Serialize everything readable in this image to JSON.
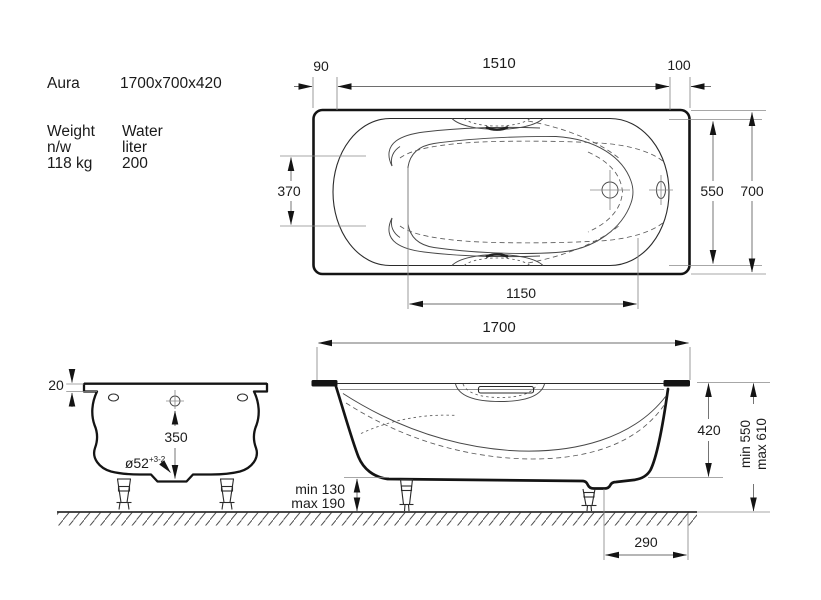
{
  "header": {
    "model": "Aura",
    "overall_size": "1700x700x420"
  },
  "specs": {
    "weight": {
      "label": "Weight",
      "sub_label": "n/w",
      "value": "118 kg"
    },
    "water": {
      "label": "Water",
      "sub_label": "liter",
      "value": "200"
    }
  },
  "top_view": {
    "left_offset": "90",
    "drain_span": "1510",
    "right_offset": "100",
    "well_width_left": "370",
    "inner_width": "550",
    "outer_width": "700",
    "well_length": "1150",
    "overall_length": "1700"
  },
  "section_view": {
    "rim_thickness": "20",
    "depth_to_drain": "350",
    "drain_diameter": "ø52",
    "drain_tolerance": "+3-2"
  },
  "side_view": {
    "leg_clearance_min": "min 130",
    "leg_clearance_max": "max 190",
    "body_height": "420",
    "total_height_min": "min 550",
    "total_height_max": "max 610",
    "drain_to_edge": "290"
  },
  "colors": {
    "background": "#ffffff",
    "line_dark": "#141414",
    "line_thin": "#8a8a8a",
    "text": "#1a1a1a"
  }
}
